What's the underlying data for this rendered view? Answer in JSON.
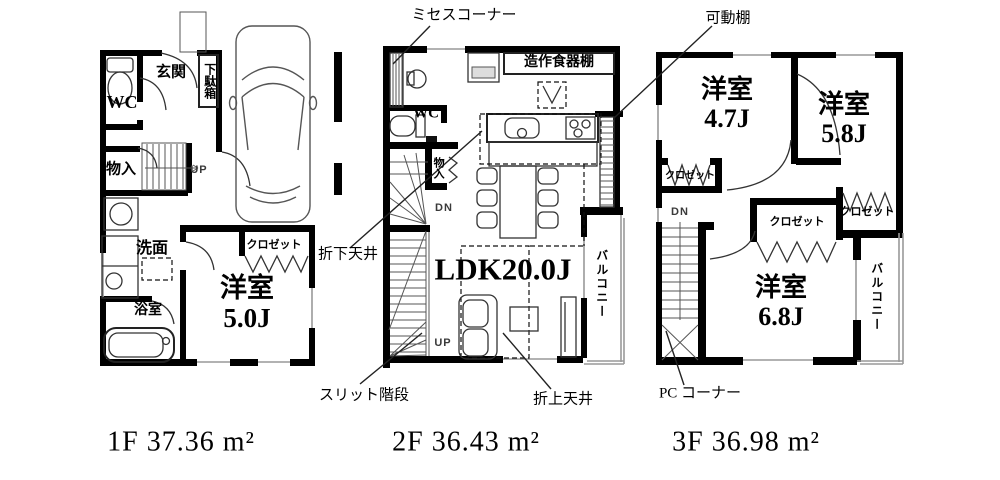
{
  "callouts": {
    "mrs_corner": "ミセスコーナー",
    "movable_shelf": "可動棚",
    "lowered_ceiling": "折下天井",
    "slit_stairs": "スリット階段",
    "raised_ceiling": "折上天井",
    "pc_corner": "PC コーナー"
  },
  "floors": {
    "f1": {
      "area": "1F 37.36 m²",
      "wc": "WC",
      "entrance": "玄関",
      "shoe_cabinet": "下駄箱",
      "storage": "物入",
      "up": "UP",
      "washroom": "洗面",
      "bathroom": "浴室",
      "room_name": "洋室",
      "room_size": "5.0J",
      "closet": "クロゼット"
    },
    "f2": {
      "area": "2F 36.43 m²",
      "wc": "WC",
      "storage": "物入",
      "dn": "DN",
      "up": "UP",
      "ldk": "LDK20.0J",
      "balcony": "バルコニー",
      "cupboard": "造作食器棚"
    },
    "f3": {
      "area": "3F 36.98 m²",
      "room1_name": "洋室",
      "room1_size": "4.7J",
      "room2_name": "洋室",
      "room2_size": "5.8J",
      "room3_name": "洋室",
      "room3_size": "6.8J",
      "closet1": "クロゼット",
      "closet2": "クロゼット",
      "closet3": "クロゼット",
      "dn": "DN",
      "balcony": "バルコニー"
    }
  }
}
